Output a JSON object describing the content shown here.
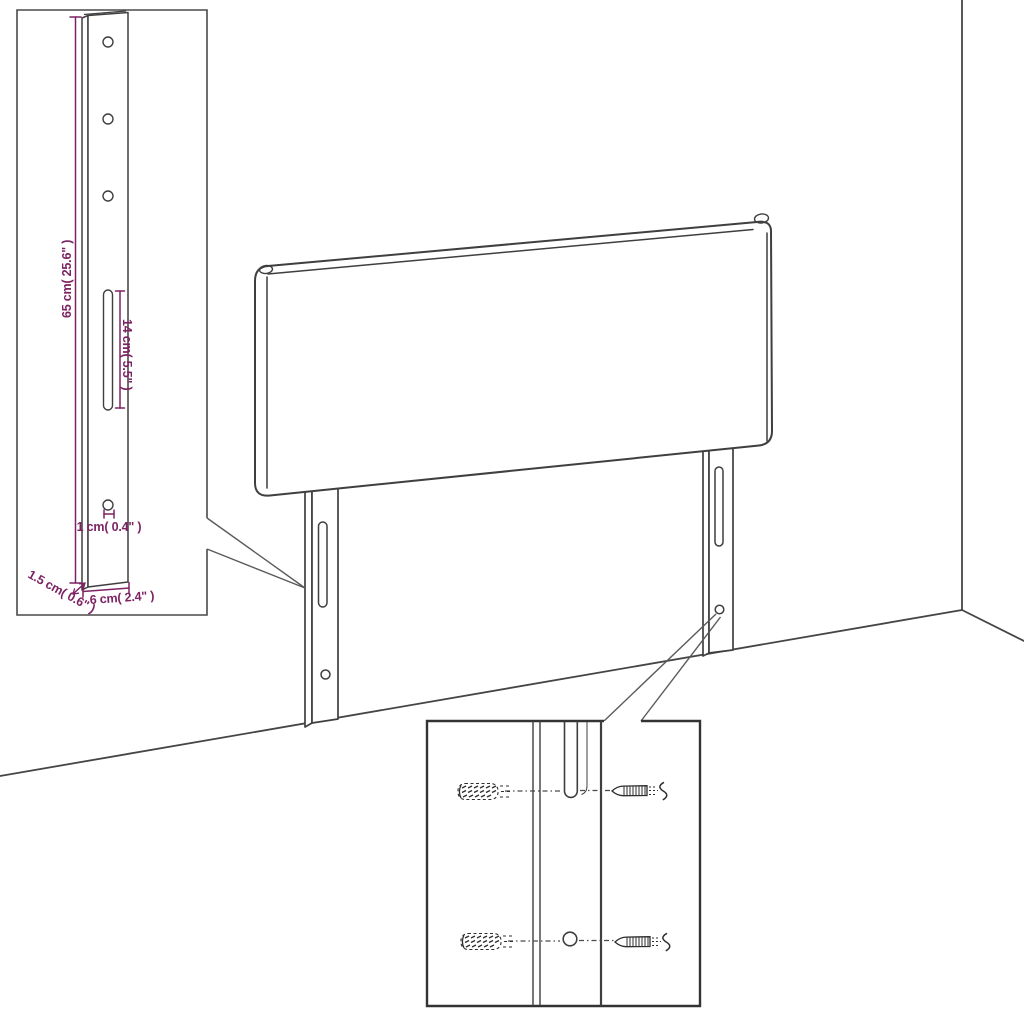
{
  "diagram": {
    "subject": "headboard-wall-mounting-assembly-diagram",
    "colors": {
      "line": "#3f3f3f",
      "inset_border": "#4a4a4a",
      "dimension": "#7d2363",
      "background": "#ffffff"
    },
    "insets": {
      "leg_detail": {
        "name": "mounting-leg-dimension-detail",
        "dimensions": {
          "height": "65 cm( 25.6\" )",
          "slot": "14 cm( 5.5\" )",
          "hole": "1 cm( 0.4\" )",
          "thickness": "1.5 cm( 0.6\" )",
          "width": "6 cm( 2.4\" )"
        }
      },
      "hardware_detail": {
        "name": "anchor-and-screw-detail",
        "parts": [
          "wall-anchor",
          "screw",
          "mounting-slot",
          "mounting-hole"
        ]
      }
    }
  }
}
